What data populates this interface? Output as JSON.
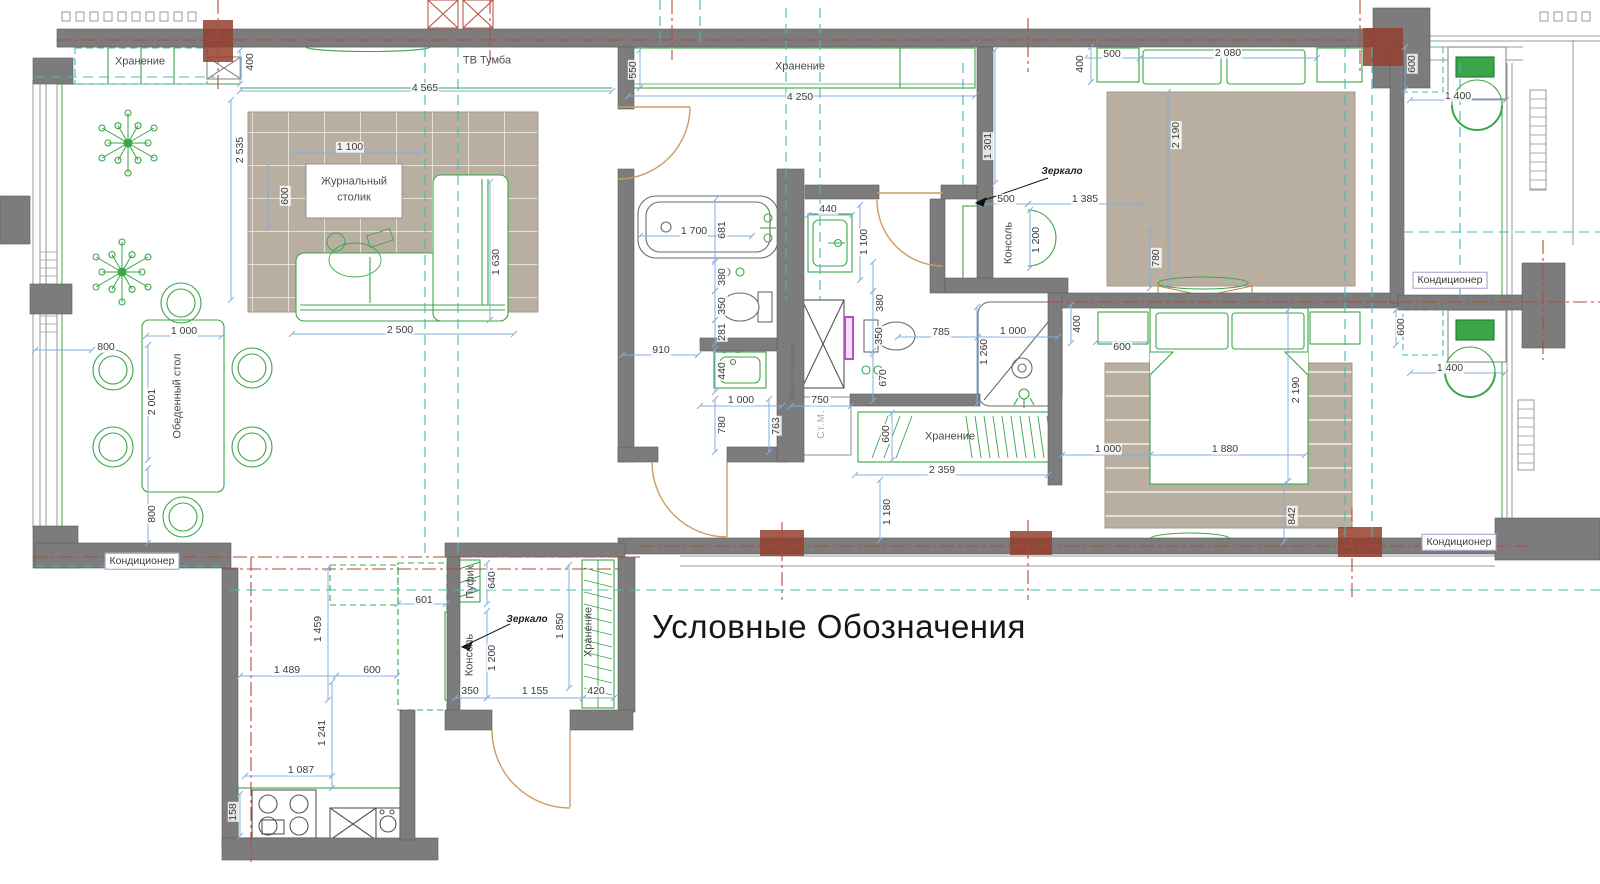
{
  "title": "Условные Обозначения",
  "colors": {
    "wall": "#7c7c7c",
    "wall_dark": "#5e5e5e",
    "column_red": "#94402f",
    "furniture_green": "#3aa648",
    "fixture_grey": "#6b6b6b",
    "dimension_blue": "#85aede",
    "axis_red": "#b5493b",
    "axis_teal": "#45b8ba",
    "rug_tan": "#b9afa0",
    "door_tan": "#cf9b62",
    "rail_purple": "#b44fc8",
    "window_grey": "#9a9a9a"
  },
  "labels": [
    {
      "t": "Хранение",
      "x": 140,
      "y": 62,
      "c": "room"
    },
    {
      "t": "400",
      "x": 250,
      "y": 62,
      "c": "dim",
      "r": 1
    },
    {
      "t": "ТВ Тумба",
      "x": 487,
      "y": 61,
      "c": "room"
    },
    {
      "t": "4 565",
      "x": 425,
      "y": 88,
      "c": "dim"
    },
    {
      "t": "2 535",
      "x": 240,
      "y": 150,
      "c": "dim",
      "r": 1
    },
    {
      "t": "1 100",
      "x": 350,
      "y": 147,
      "c": "dim"
    },
    {
      "t": "600",
      "x": 285,
      "y": 196,
      "c": "dim",
      "r": 1
    },
    {
      "t": "Журнальный",
      "x": 354,
      "y": 182,
      "c": "room"
    },
    {
      "t": "столик",
      "x": 354,
      "y": 198,
      "c": "room"
    },
    {
      "t": "1 630",
      "x": 496,
      "y": 262,
      "c": "dim",
      "r": 1
    },
    {
      "t": "2 500",
      "x": 400,
      "y": 330,
      "c": "dim"
    },
    {
      "t": "1 000",
      "x": 184,
      "y": 331,
      "c": "dim"
    },
    {
      "t": "800",
      "x": 106,
      "y": 347,
      "c": "dim"
    },
    {
      "t": "Обеденный стол",
      "x": 178,
      "y": 396,
      "c": "room",
      "r": 1
    },
    {
      "t": "2 001",
      "x": 152,
      "y": 402,
      "c": "dim",
      "r": 1
    },
    {
      "t": "800",
      "x": 152,
      "y": 514,
      "c": "dim",
      "r": 1
    },
    {
      "t": "Кондиционер",
      "x": 142,
      "y": 561,
      "c": "boxed"
    },
    {
      "t": "550",
      "x": 633,
      "y": 70,
      "c": "dim",
      "r": 1
    },
    {
      "t": "Хранение",
      "x": 800,
      "y": 67,
      "c": "room"
    },
    {
      "t": "4 250",
      "x": 800,
      "y": 97,
      "c": "dim"
    },
    {
      "t": "1 301",
      "x": 988,
      "y": 146,
      "c": "dim",
      "r": 1
    },
    {
      "t": "500",
      "x": 1112,
      "y": 54,
      "c": "dim"
    },
    {
      "t": "2 080",
      "x": 1228,
      "y": 53,
      "c": "dim"
    },
    {
      "t": "400",
      "x": 1080,
      "y": 64,
      "c": "dim",
      "r": 1
    },
    {
      "t": "2 190",
      "x": 1176,
      "y": 135,
      "c": "dim",
      "r": 1
    },
    {
      "t": "Зеркало",
      "x": 1062,
      "y": 172,
      "c": "room i"
    },
    {
      "t": "500",
      "x": 1006,
      "y": 199,
      "c": "dim"
    },
    {
      "t": "1 385",
      "x": 1085,
      "y": 199,
      "c": "dim"
    },
    {
      "t": "Консоль",
      "x": 1009,
      "y": 243,
      "c": "room",
      "r": 1
    },
    {
      "t": "1 200",
      "x": 1036,
      "y": 240,
      "c": "dim",
      "r": 1
    },
    {
      "t": "780",
      "x": 1156,
      "y": 258,
      "c": "dim",
      "r": 1
    },
    {
      "t": "600",
      "x": 1412,
      "y": 64,
      "c": "dim",
      "r": 1
    },
    {
      "t": "1 400",
      "x": 1458,
      "y": 96,
      "c": "dim"
    },
    {
      "t": "Кондиционер",
      "x": 1450,
      "y": 280,
      "c": "boxed"
    },
    {
      "t": "600",
      "x": 1401,
      "y": 327,
      "c": "dim",
      "r": 1
    },
    {
      "t": "1 400",
      "x": 1450,
      "y": 368,
      "c": "dim"
    },
    {
      "t": "Кондиционер",
      "x": 1459,
      "y": 542,
      "c": "boxed"
    },
    {
      "t": "1 700",
      "x": 694,
      "y": 231,
      "c": "dim"
    },
    {
      "t": "681",
      "x": 722,
      "y": 230,
      "c": "dim",
      "r": 1
    },
    {
      "t": "380",
      "x": 722,
      "y": 277,
      "c": "dim",
      "r": 1
    },
    {
      "t": "350",
      "x": 722,
      "y": 306,
      "c": "dim",
      "r": 1
    },
    {
      "t": "281",
      "x": 722,
      "y": 332,
      "c": "dim",
      "r": 1
    },
    {
      "t": "910",
      "x": 661,
      "y": 350,
      "c": "dim"
    },
    {
      "t": "440",
      "x": 722,
      "y": 371,
      "c": "dim",
      "r": 1
    },
    {
      "t": "1 000",
      "x": 741,
      "y": 400,
      "c": "dim"
    },
    {
      "t": "780",
      "x": 722,
      "y": 425,
      "c": "dim",
      "r": 1
    },
    {
      "t": "763",
      "x": 776,
      "y": 426,
      "c": "dim",
      "r": 1
    },
    {
      "t": "750",
      "x": 820,
      "y": 400,
      "c": "dim"
    },
    {
      "t": "Ниша с полками",
      "x": 792,
      "y": 372,
      "c": "tiny",
      "r": 1
    },
    {
      "t": "Ст.М.",
      "x": 822,
      "y": 424,
      "c": "stm",
      "r": 1
    },
    {
      "t": "440",
      "x": 828,
      "y": 209,
      "c": "dim"
    },
    {
      "t": "1 100",
      "x": 864,
      "y": 242,
      "c": "dim",
      "r": 1
    },
    {
      "t": "380",
      "x": 880,
      "y": 303,
      "c": "dim",
      "r": 1
    },
    {
      "t": "350",
      "x": 879,
      "y": 336,
      "c": "dim",
      "r": 1
    },
    {
      "t": "670",
      "x": 883,
      "y": 378,
      "c": "dim",
      "r": 1
    },
    {
      "t": "785",
      "x": 941,
      "y": 332,
      "c": "dim"
    },
    {
      "t": "1 000",
      "x": 1013,
      "y": 331,
      "c": "dim"
    },
    {
      "t": "1 260",
      "x": 984,
      "y": 352,
      "c": "dim",
      "r": 1
    },
    {
      "t": "400",
      "x": 1077,
      "y": 324,
      "c": "dim",
      "r": 1
    },
    {
      "t": "600",
      "x": 886,
      "y": 434,
      "c": "dim",
      "r": 1
    },
    {
      "t": "Хранение",
      "x": 950,
      "y": 437,
      "c": "room"
    },
    {
      "t": "2 359",
      "x": 942,
      "y": 470,
      "c": "dim"
    },
    {
      "t": "1 180",
      "x": 887,
      "y": 512,
      "c": "dim",
      "r": 1
    },
    {
      "t": "600",
      "x": 1122,
      "y": 347,
      "c": "dim"
    },
    {
      "t": "2 190",
      "x": 1296,
      "y": 390,
      "c": "dim",
      "r": 1
    },
    {
      "t": "1 000",
      "x": 1108,
      "y": 449,
      "c": "dim"
    },
    {
      "t": "1 880",
      "x": 1225,
      "y": 449,
      "c": "dim"
    },
    {
      "t": "842",
      "x": 1292,
      "y": 516,
      "c": "dim",
      "r": 1
    },
    {
      "t": "1 459",
      "x": 318,
      "y": 629,
      "c": "dim",
      "r": 1
    },
    {
      "t": "601",
      "x": 424,
      "y": 600,
      "c": "dim"
    },
    {
      "t": "1 489",
      "x": 287,
      "y": 670,
      "c": "dim"
    },
    {
      "t": "600",
      "x": 372,
      "y": 670,
      "c": "dim"
    },
    {
      "t": "1 241",
      "x": 322,
      "y": 733,
      "c": "dim",
      "r": 1
    },
    {
      "t": "1 087",
      "x": 301,
      "y": 770,
      "c": "dim"
    },
    {
      "t": "158",
      "x": 233,
      "y": 812,
      "c": "dim",
      "r": 1
    },
    {
      "t": "Пуфик",
      "x": 471,
      "y": 582,
      "c": "room",
      "r": 1
    },
    {
      "t": "640",
      "x": 492,
      "y": 580,
      "c": "dim",
      "r": 1
    },
    {
      "t": "Зеркало",
      "x": 527,
      "y": 620,
      "c": "room i"
    },
    {
      "t": "Консоль",
      "x": 470,
      "y": 655,
      "c": "room",
      "r": 1
    },
    {
      "t": "1 200",
      "x": 492,
      "y": 658,
      "c": "dim",
      "r": 1
    },
    {
      "t": "1 850",
      "x": 560,
      "y": 626,
      "c": "dim",
      "r": 1
    },
    {
      "t": "Хранение",
      "x": 589,
      "y": 632,
      "c": "room",
      "r": 1
    },
    {
      "t": "350",
      "x": 470,
      "y": 691,
      "c": "dim"
    },
    {
      "t": "1 155",
      "x": 535,
      "y": 691,
      "c": "dim"
    },
    {
      "t": "420",
      "x": 596,
      "y": 691,
      "c": "dim"
    }
  ]
}
